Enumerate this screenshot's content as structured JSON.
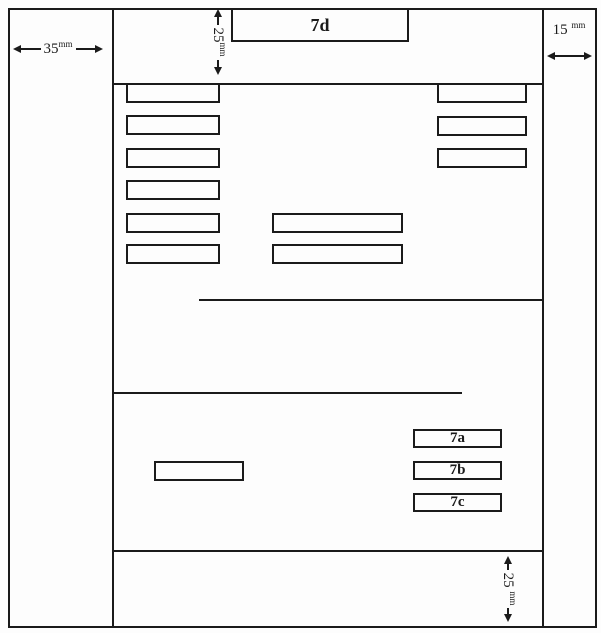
{
  "colors": {
    "ink": "#1b1b1b",
    "paper": "#fdfdfd"
  },
  "measurements": {
    "left": {
      "value": "35",
      "unit": "mm"
    },
    "top": {
      "value": "25",
      "unit": "mm"
    },
    "right": {
      "value": "15",
      "unit": "mm"
    },
    "bottom": {
      "value": "25",
      "unit": "mm"
    }
  },
  "boxes": {
    "d": {
      "label": "7d"
    },
    "a": {
      "label": "7a"
    },
    "b": {
      "label": "7b"
    },
    "c": {
      "label": "7c"
    }
  },
  "icons": {
    "arrowhead_left": "left-pointing triangle",
    "arrowhead_right": "right-pointing triangle"
  }
}
